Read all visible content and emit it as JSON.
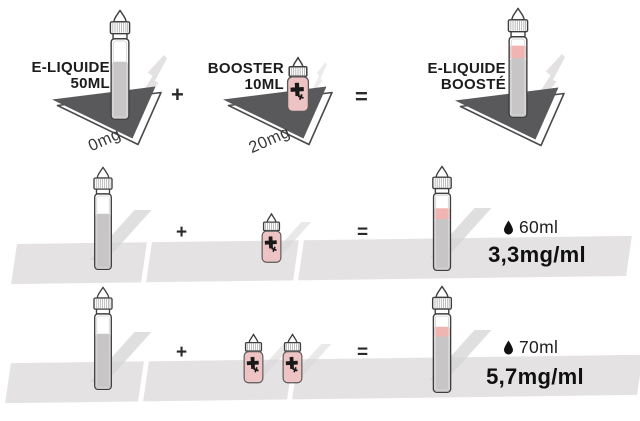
{
  "colors": {
    "booster_pink": "#eec3c3",
    "boost_pink": "#f1b5b1",
    "liquid_gray": "#c7c5c5",
    "triangle_dark": "#59585a",
    "band_gray": "#e4e2e2",
    "ink": "#1c1c1c"
  },
  "icons": {
    "volume_unit": "droplet-icon",
    "booster_mark": "plus-icon"
  },
  "recipe_row": {
    "base_label_line1": "E-LIQUIDE",
    "base_label_line2": "50ML",
    "base_strength": "0mg",
    "plus": "+",
    "booster_label_line1": "BOOSTER",
    "booster_label_line2": "10ML",
    "booster_strength": "20mg",
    "equals": "=",
    "result_label_line1": "E-LIQUIDE",
    "result_label_line2": "BOOSTÉ"
  },
  "mix_rows": [
    {
      "plus": "+",
      "equals": "=",
      "boosters": 1,
      "volume": "60ml",
      "concentration": "3,3mg/ml"
    },
    {
      "plus": "+",
      "equals": "=",
      "boosters": 2,
      "volume": "70ml",
      "concentration": "5,7mg/ml"
    }
  ]
}
